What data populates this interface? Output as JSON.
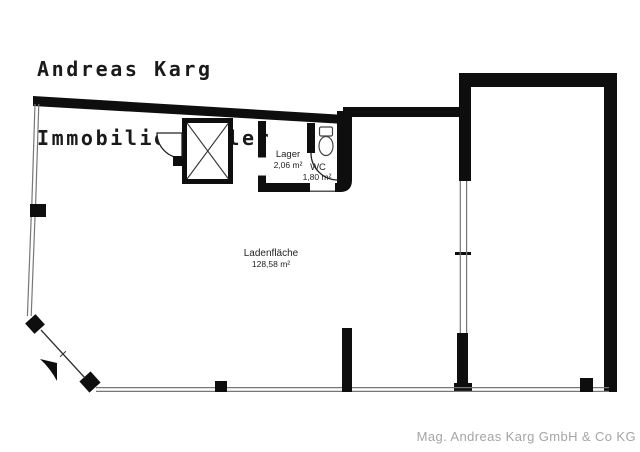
{
  "header": {
    "line1": "Andreas Karg",
    "line2": "Immobilienmakler"
  },
  "rooms": {
    "lager": {
      "name": "Lager",
      "area": "2,06 m²"
    },
    "wc": {
      "name": "WC",
      "area": "1,80 m²"
    },
    "laden": {
      "name": "Ladenfläche",
      "area": "128,58 m²"
    }
  },
  "footer": {
    "company": "Mag. Andreas Karg GmbH & Co KG"
  },
  "colors": {
    "wall": "#0e0e0e",
    "window_line": "#777777",
    "label_text": "#222222",
    "footer_text": "#a5a5a5",
    "background": "#ffffff"
  }
}
